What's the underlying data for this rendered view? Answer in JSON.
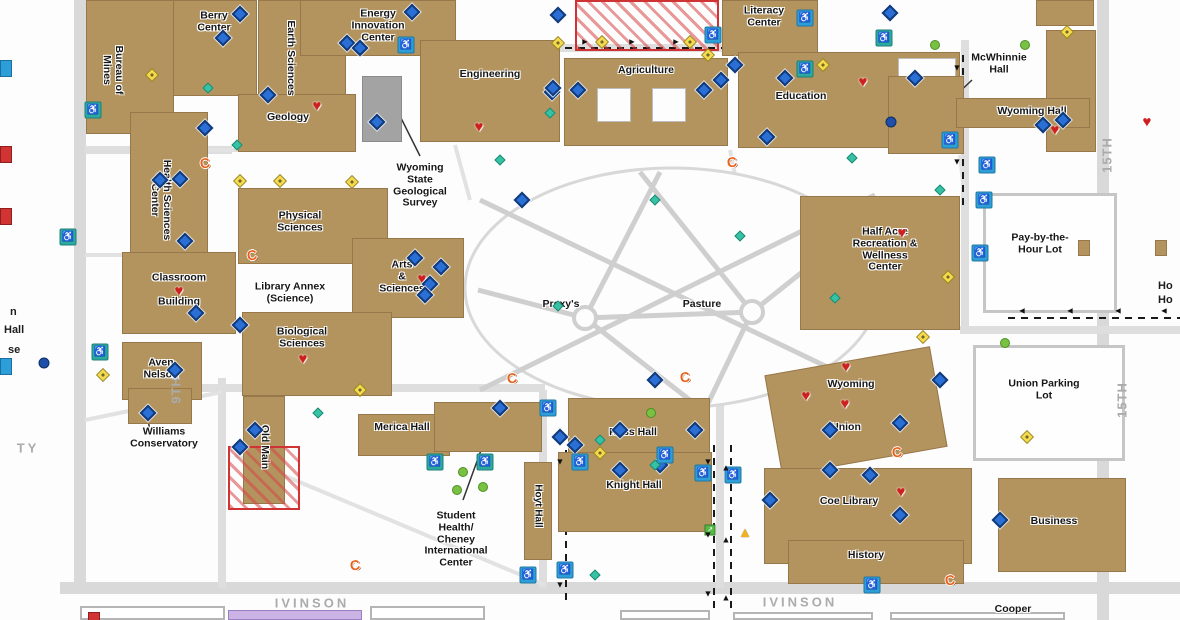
{
  "map_title": "University campus map",
  "colors": {
    "building": "#b3935e",
    "building_border": "#97784a",
    "gray_building": "#a3a3a3",
    "road": "#d9d9d9",
    "street_label": "#ababab",
    "label": "#161616",
    "construction": "#cf3333",
    "blue_diamond": "#2a6fd6",
    "parking_blue": "#2d9fd8",
    "parking_teal": "#2aaaa0",
    "yellow_diamond": "#f7d94c",
    "green_dot": "#79c143",
    "teal_diamond": "#36c2a5",
    "heart": "#cf2020",
    "phone": "#e8611c",
    "purple_building": "#cbb3e6"
  },
  "buildings": [
    {
      "id": "pay-by-the-hour-lot-area",
      "x": 984,
      "y": 194,
      "w": 132,
      "h": 118,
      "fill": "lot",
      "label": ""
    },
    {
      "id": "union-parking-lot-area",
      "x": 974,
      "y": 346,
      "w": 150,
      "h": 114,
      "fill": "lot",
      "label": ""
    },
    {
      "id": "bottom-building-1",
      "x": 80,
      "y": 606,
      "w": 145,
      "h": 14,
      "fill": "outline",
      "label": ""
    },
    {
      "id": "bottom-building-2",
      "x": 370,
      "y": 606,
      "w": 115,
      "h": 14,
      "fill": "outline",
      "label": ""
    },
    {
      "id": "bottom-building-3",
      "x": 620,
      "y": 610,
      "w": 90,
      "h": 10,
      "fill": "outline",
      "label": ""
    },
    {
      "id": "bottom-building-4",
      "x": 733,
      "y": 612,
      "w": 140,
      "h": 8,
      "fill": "outline",
      "label": ""
    },
    {
      "id": "bottom-building-5",
      "x": 890,
      "y": 612,
      "w": 175,
      "h": 8,
      "fill": "outline",
      "label": ""
    },
    {
      "id": "bottom-purple-building",
      "x": 228,
      "y": 610,
      "w": 134,
      "h": 10,
      "fill": "purple",
      "label": ""
    },
    {
      "id": "berry-center",
      "x": 155,
      "y": 0,
      "w": 102,
      "h": 96,
      "label": "Berry\nCenter",
      "lx": 214,
      "ly": 22
    },
    {
      "id": "bureau-of-mines",
      "x": 86,
      "y": 0,
      "w": 88,
      "h": 134,
      "label": "Bureau of\nMines",
      "lx": 112,
      "ly": 70,
      "vert": true
    },
    {
      "id": "earth-sciences",
      "x": 258,
      "y": 0,
      "w": 88,
      "h": 112,
      "label": "Earth Sciences",
      "lx": 290,
      "ly": 58,
      "vert": true
    },
    {
      "id": "energy-innovation-center",
      "x": 300,
      "y": 0,
      "w": 156,
      "h": 56,
      "label": "Energy\nInnovation\nCenter",
      "lx": 378,
      "ly": 26
    },
    {
      "id": "engineering",
      "x": 420,
      "y": 40,
      "w": 140,
      "h": 102,
      "label": "Engineering",
      "lx": 490,
      "ly": 75
    },
    {
      "id": "geological-survey-building",
      "x": 362,
      "y": 76,
      "w": 40,
      "h": 66,
      "fill": "gray",
      "label": ""
    },
    {
      "id": "agriculture",
      "x": 564,
      "y": 58,
      "w": 164,
      "h": 88,
      "label": "Agriculture",
      "lx": 646,
      "ly": 71
    },
    {
      "id": "agriculture-courtyard-1",
      "x": 597,
      "y": 88,
      "w": 34,
      "h": 34,
      "fill": "white",
      "label": ""
    },
    {
      "id": "agriculture-courtyard-2",
      "x": 652,
      "y": 88,
      "w": 34,
      "h": 34,
      "fill": "white",
      "label": ""
    },
    {
      "id": "literacy-center",
      "x": 722,
      "y": 0,
      "w": 96,
      "h": 56,
      "label": "Literacy\nCenter",
      "lx": 764,
      "ly": 17
    },
    {
      "id": "education",
      "x": 738,
      "y": 52,
      "w": 222,
      "h": 96,
      "label": "Education",
      "lx": 801,
      "ly": 97
    },
    {
      "id": "education-courtyard",
      "x": 898,
      "y": 58,
      "w": 58,
      "h": 56,
      "fill": "white",
      "label": ""
    },
    {
      "id": "mcwhinnie-hall",
      "x": 888,
      "y": 76,
      "w": 76,
      "h": 78,
      "label": ""
    },
    {
      "id": "wyoming-hall-tower",
      "x": 1046,
      "y": 30,
      "w": 50,
      "h": 122,
      "label": ""
    },
    {
      "id": "wyoming-hall-wing",
      "x": 956,
      "y": 98,
      "w": 134,
      "h": 30,
      "label": ""
    },
    {
      "id": "ne-corner-building",
      "x": 1036,
      "y": 0,
      "w": 58,
      "h": 26,
      "label": ""
    },
    {
      "id": "geology",
      "x": 238,
      "y": 94,
      "w": 118,
      "h": 58,
      "label": "Geology",
      "lx": 288,
      "ly": 118
    },
    {
      "id": "health-sciences-center",
      "x": 130,
      "y": 112,
      "w": 78,
      "h": 190,
      "label": "Health Sciences\nCenter",
      "lx": 160,
      "ly": 200,
      "vert": true
    },
    {
      "id": "physical-sciences",
      "x": 238,
      "y": 188,
      "w": 150,
      "h": 76,
      "label": "Physical\nSciences",
      "lx": 300,
      "ly": 222
    },
    {
      "id": "arts-sciences",
      "x": 352,
      "y": 238,
      "w": 112,
      "h": 80,
      "label": "Arts\n&\nSciences",
      "lx": 402,
      "ly": 277
    },
    {
      "id": "biological-sciences",
      "x": 242,
      "y": 312,
      "w": 150,
      "h": 84,
      "label": "Biological\nSciences",
      "lx": 302,
      "ly": 338
    },
    {
      "id": "classroom-building",
      "x": 122,
      "y": 252,
      "w": 114,
      "h": 82,
      "label": "Classroom\n\nBuilding",
      "lx": 179,
      "ly": 290
    },
    {
      "id": "aven-nelson",
      "x": 122,
      "y": 342,
      "w": 80,
      "h": 58,
      "label": "Aven\nNelson",
      "lx": 161,
      "ly": 369
    },
    {
      "id": "williams-conservatory-building",
      "x": 128,
      "y": 388,
      "w": 64,
      "h": 36,
      "label": ""
    },
    {
      "id": "old-main",
      "x": 243,
      "y": 396,
      "w": 42,
      "h": 108,
      "label": "Old Main",
      "lx": 264,
      "ly": 447,
      "vert": true
    },
    {
      "id": "merica-hall-building",
      "x": 358,
      "y": 414,
      "w": 92,
      "h": 42,
      "label": ""
    },
    {
      "id": "health-center-building",
      "x": 434,
      "y": 402,
      "w": 108,
      "h": 50,
      "label": ""
    },
    {
      "id": "ross-hall",
      "x": 568,
      "y": 398,
      "w": 142,
      "h": 58,
      "label": "Ross Hall",
      "lx": 633,
      "ly": 433
    },
    {
      "id": "knight-hall",
      "x": 558,
      "y": 452,
      "w": 154,
      "h": 80,
      "label": "Knight Hall",
      "lx": 634,
      "ly": 486
    },
    {
      "id": "hoyt-hall",
      "x": 524,
      "y": 462,
      "w": 28,
      "h": 98,
      "label": "Hoyt Hall",
      "lx": 538,
      "ly": 506,
      "vert": true,
      "fs": 10
    },
    {
      "id": "wyoming-union-building",
      "x": 772,
      "y": 360,
      "w": 168,
      "h": 102,
      "rot": -10,
      "label": ""
    },
    {
      "id": "half-acre",
      "x": 800,
      "y": 196,
      "w": 160,
      "h": 134,
      "label": "Half Acre\nRecreation &\nWellness\nCenter",
      "lx": 885,
      "ly": 250
    },
    {
      "id": "coe-library",
      "x": 764,
      "y": 468,
      "w": 208,
      "h": 96,
      "label": "Coe Library",
      "lx": 849,
      "ly": 502
    },
    {
      "id": "history",
      "x": 788,
      "y": 540,
      "w": 176,
      "h": 44,
      "label": "History",
      "lx": 866,
      "ly": 556
    },
    {
      "id": "business",
      "x": 998,
      "y": 478,
      "w": 128,
      "h": 94,
      "label": "Business",
      "lx": 1054,
      "ly": 522
    },
    {
      "id": "pay-lot-kiosk-1",
      "x": 1078,
      "y": 240,
      "w": 12,
      "h": 16,
      "label": ""
    },
    {
      "id": "pay-lot-kiosk-2",
      "x": 1155,
      "y": 240,
      "w": 12,
      "h": 16,
      "label": ""
    }
  ],
  "floating_labels": [
    {
      "id": "wyoming-state-geological-survey",
      "text": "Wyoming\nState\nGeological\nSurvey",
      "x": 420,
      "y": 186
    },
    {
      "id": "mcwhinnie-hall",
      "text": "McWhinnie\nHall",
      "x": 999,
      "y": 64
    },
    {
      "id": "wyoming-hall",
      "text": "Wyoming Hall",
      "x": 1032,
      "y": 112
    },
    {
      "id": "library-annex-science",
      "text": "Library Annex\n(Science)",
      "x": 290,
      "y": 293
    },
    {
      "id": "williams-conservatory",
      "text": "Williams\nConservatory",
      "x": 164,
      "y": 438
    },
    {
      "id": "merica-hall",
      "text": "Merica Hall",
      "x": 402,
      "y": 428
    },
    {
      "id": "student-health-cheney-international-center",
      "text": "Student\nHealth/\nCheney\nInternational\nCenter",
      "x": 456,
      "y": 540
    },
    {
      "id": "prexys",
      "text": "Prexy's",
      "x": 561,
      "y": 305
    },
    {
      "id": "pasture",
      "text": "Pasture",
      "x": 702,
      "y": 305
    },
    {
      "id": "pay-by-the-hour-lot",
      "text": "Pay-by-the-\nHour Lot",
      "x": 1040,
      "y": 244
    },
    {
      "id": "union-parking-lot",
      "text": "Union Parking\nLot",
      "x": 1044,
      "y": 390
    },
    {
      "id": "wyoming-union-line1",
      "text": "Wyoming",
      "x": 851,
      "y": 385
    },
    {
      "id": "wyoming-union-line2",
      "text": "Union",
      "x": 846,
      "y": 428
    },
    {
      "id": "cooper",
      "text": "Cooper",
      "x": 1013,
      "y": 610
    }
  ],
  "streets": [
    {
      "label": "9TH",
      "x": 176,
      "y": 390,
      "vert": true
    },
    {
      "label": "15TH",
      "x": 1107,
      "y": 155,
      "vert": true
    },
    {
      "label": "15TH",
      "x": 1122,
      "y": 400,
      "vert": true
    },
    {
      "label": "IVINSON",
      "x": 312,
      "y": 603,
      "vert": false
    },
    {
      "label": "IVINSON",
      "x": 800,
      "y": 602,
      "vert": false
    },
    {
      "label": "TY",
      "x": 28,
      "y": 448,
      "vert": false
    }
  ],
  "edge_labels": [
    {
      "text": "n",
      "x": 10,
      "y": 306
    },
    {
      "text": "Hall",
      "x": 4,
      "y": 324
    },
    {
      "text": "se",
      "x": 8,
      "y": 344
    },
    {
      "text": "Ho",
      "x": 1158,
      "y": 280
    },
    {
      "text": "Ho",
      "x": 1158,
      "y": 294
    }
  ],
  "construction_zones": [
    {
      "x": 575,
      "y": 0,
      "w": 140,
      "h": 47
    },
    {
      "x": 228,
      "y": 446,
      "w": 68,
      "h": 60
    }
  ],
  "icons": {
    "hearts": [
      [
        317,
        106
      ],
      [
        479,
        127
      ],
      [
        160,
        177
      ],
      [
        179,
        291
      ],
      [
        422,
        279
      ],
      [
        303,
        359
      ],
      [
        902,
        233
      ],
      [
        846,
        367
      ],
      [
        806,
        396
      ],
      [
        845,
        404
      ],
      [
        901,
        492
      ],
      [
        1055,
        130
      ],
      [
        863,
        82
      ],
      [
        1147,
        122
      ]
    ],
    "phones": [
      [
        205,
        163
      ],
      [
        252,
        255
      ],
      [
        732,
        162
      ],
      [
        512,
        378
      ],
      [
        685,
        377
      ],
      [
        897,
        452
      ],
      [
        355,
        565
      ],
      [
        950,
        580
      ]
    ],
    "blue_diamonds": [
      [
        223,
        38
      ],
      [
        268,
        95
      ],
      [
        347,
        43
      ],
      [
        360,
        48
      ],
      [
        412,
        12
      ],
      [
        377,
        122
      ],
      [
        552,
        92
      ],
      [
        578,
        90
      ],
      [
        558,
        15
      ],
      [
        553,
        88
      ],
      [
        704,
        90
      ],
      [
        721,
        80
      ],
      [
        735,
        65
      ],
      [
        767,
        137
      ],
      [
        785,
        78
      ],
      [
        915,
        78
      ],
      [
        1063,
        120
      ],
      [
        1043,
        125
      ],
      [
        890,
        13
      ],
      [
        160,
        180
      ],
      [
        180,
        179
      ],
      [
        205,
        128
      ],
      [
        185,
        241
      ],
      [
        196,
        313
      ],
      [
        240,
        325
      ],
      [
        175,
        370
      ],
      [
        148,
        413
      ],
      [
        255,
        430
      ],
      [
        240,
        447
      ],
      [
        415,
        258
      ],
      [
        441,
        267
      ],
      [
        430,
        284
      ],
      [
        425,
        295
      ],
      [
        522,
        200
      ],
      [
        500,
        408
      ],
      [
        560,
        437
      ],
      [
        655,
        380
      ],
      [
        620,
        430
      ],
      [
        575,
        445
      ],
      [
        620,
        470
      ],
      [
        660,
        465
      ],
      [
        695,
        430
      ],
      [
        770,
        500
      ],
      [
        870,
        475
      ],
      [
        900,
        515
      ],
      [
        940,
        380
      ],
      [
        830,
        470
      ],
      [
        900,
        423
      ],
      [
        1000,
        520
      ],
      [
        240,
        14
      ],
      [
        830,
        430
      ]
    ],
    "parking_blue": [
      [
        406,
        45
      ],
      [
        713,
        35
      ],
      [
        805,
        18
      ],
      [
        950,
        140
      ],
      [
        987,
        165
      ],
      [
        548,
        408
      ],
      [
        580,
        462
      ],
      [
        665,
        455
      ],
      [
        703,
        473
      ],
      [
        733,
        475
      ],
      [
        565,
        570
      ],
      [
        528,
        575
      ],
      [
        872,
        585
      ],
      [
        984,
        200
      ],
      [
        980,
        253
      ]
    ],
    "parking_teal": [
      [
        93,
        110
      ],
      [
        68,
        237
      ],
      [
        100,
        352
      ],
      [
        884,
        38
      ],
      [
        805,
        69
      ],
      [
        435,
        462
      ],
      [
        485,
        462
      ]
    ],
    "yellow_diamonds": [
      [
        152,
        75
      ],
      [
        240,
        181
      ],
      [
        280,
        181
      ],
      [
        352,
        182
      ],
      [
        558,
        43
      ],
      [
        602,
        42
      ],
      [
        690,
        42
      ],
      [
        708,
        55
      ],
      [
        1067,
        32
      ],
      [
        103,
        375
      ],
      [
        360,
        390
      ],
      [
        948,
        277
      ],
      [
        923,
        337
      ],
      [
        600,
        453
      ],
      [
        1027,
        437
      ],
      [
        823,
        65
      ]
    ],
    "green_dots": [
      [
        935,
        45
      ],
      [
        1025,
        45
      ],
      [
        1005,
        343
      ],
      [
        463,
        472
      ],
      [
        483,
        487
      ],
      [
        457,
        490
      ],
      [
        651,
        413
      ]
    ],
    "teal_diamonds": [
      [
        208,
        88
      ],
      [
        237,
        145
      ],
      [
        550,
        113
      ],
      [
        500,
        160
      ],
      [
        655,
        200
      ],
      [
        852,
        158
      ],
      [
        940,
        190
      ],
      [
        740,
        236
      ],
      [
        558,
        306
      ],
      [
        835,
        298
      ],
      [
        600,
        440
      ],
      [
        655,
        465
      ],
      [
        318,
        413
      ],
      [
        595,
        575
      ]
    ],
    "dark_dots": [
      [
        891,
        122
      ],
      [
        44,
        363
      ]
    ],
    "triangles": [
      [
        745,
        532
      ]
    ],
    "green_squares": [
      [
        710,
        530
      ]
    ],
    "partial_blue": [
      [
        0,
        60
      ],
      [
        0,
        358
      ]
    ],
    "partial_red": [
      [
        0,
        146
      ],
      [
        0,
        208
      ],
      [
        88,
        612
      ]
    ]
  },
  "arrows": [
    {
      "ch": "►",
      "x": 585,
      "y": 42
    },
    {
      "ch": "►",
      "x": 632,
      "y": 42
    },
    {
      "ch": "►",
      "x": 676,
      "y": 42
    },
    {
      "ch": "▼",
      "x": 957,
      "y": 68
    },
    {
      "ch": "▼",
      "x": 957,
      "y": 162
    },
    {
      "ch": "◄",
      "x": 1022,
      "y": 311
    },
    {
      "ch": "◄",
      "x": 1070,
      "y": 311
    },
    {
      "ch": "◄",
      "x": 1118,
      "y": 311
    },
    {
      "ch": "◄",
      "x": 1164,
      "y": 311
    },
    {
      "ch": "▼",
      "x": 708,
      "y": 462
    },
    {
      "ch": "▼",
      "x": 708,
      "y": 535
    },
    {
      "ch": "▼",
      "x": 708,
      "y": 594
    },
    {
      "ch": "▲",
      "x": 726,
      "y": 468
    },
    {
      "ch": "▲",
      "x": 726,
      "y": 540
    },
    {
      "ch": "▲",
      "x": 726,
      "y": 598
    },
    {
      "ch": "▼",
      "x": 560,
      "y": 462
    },
    {
      "ch": "▼",
      "x": 560,
      "y": 585
    }
  ]
}
